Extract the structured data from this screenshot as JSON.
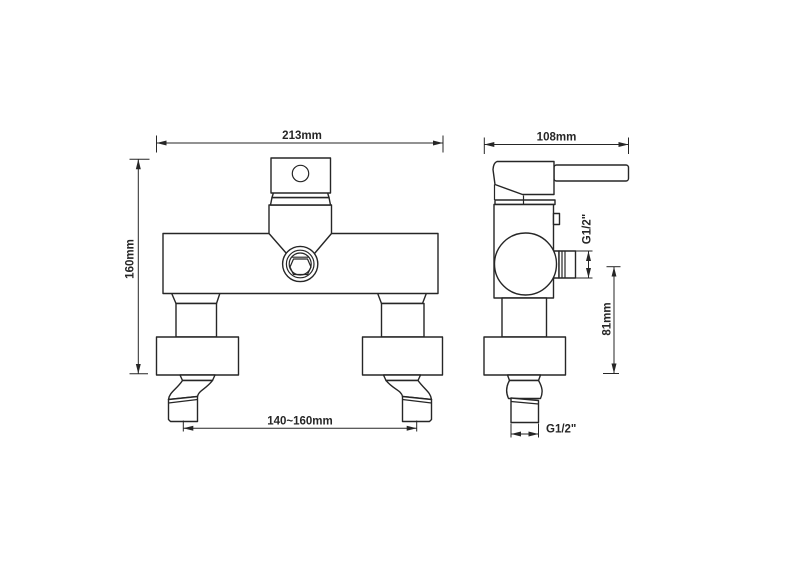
{
  "page": {
    "background": "#ffffff",
    "line_color": "#262626",
    "description": "Technical dimension drawing of a wall-mounted shower mixer faucet, front and side orthographic views"
  },
  "drawing": {
    "front_view": {
      "width_dim": "213mm",
      "height_dim": "160mm",
      "inlet_spacing_dim": "140~160mm"
    },
    "side_view": {
      "depth_dim": "108mm",
      "outlet_thread_dim": "G1/2\"",
      "outlet_height_dim": "81mm",
      "inlet_thread_dim": "G1/2\""
    }
  }
}
